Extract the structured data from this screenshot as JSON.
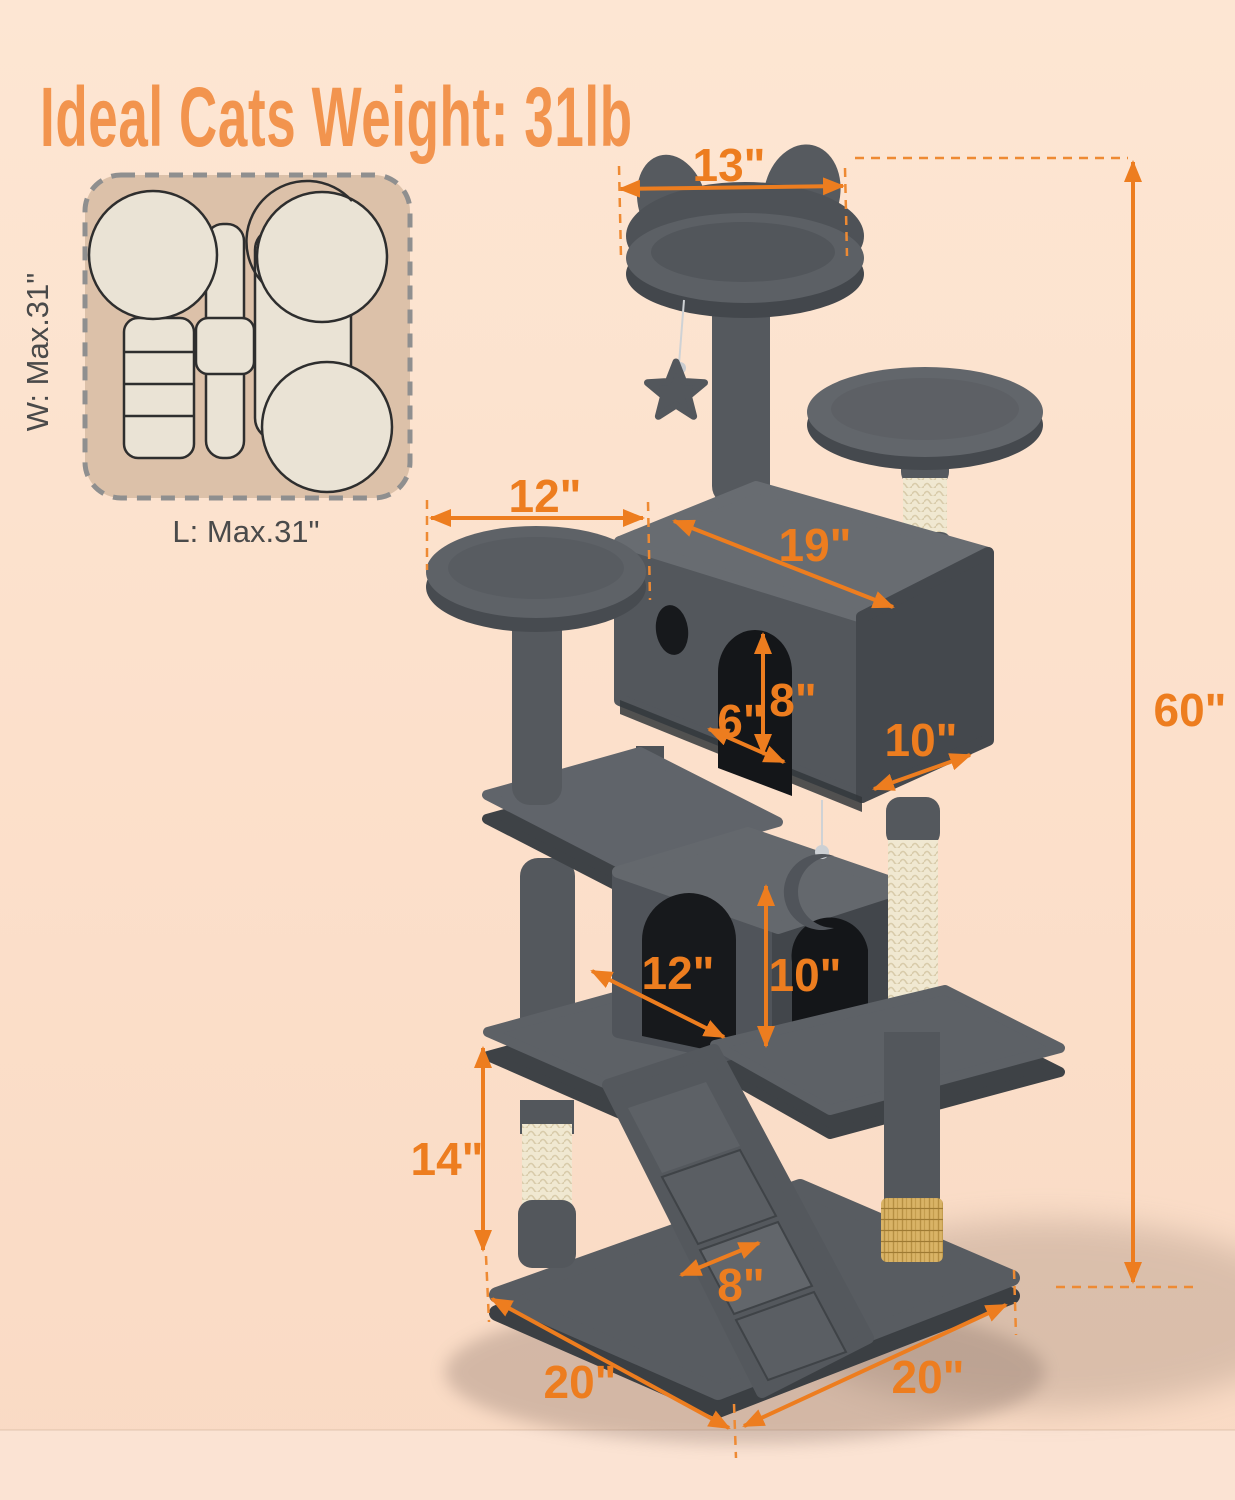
{
  "title": "Ideal Cats Weight: 31lb",
  "footprint_diagram": {
    "width_label": "W: Max.31\"",
    "length_label": "L: Max.31\""
  },
  "dimensions": {
    "top_perch_width": "13\"",
    "total_height": "60\"",
    "left_perch_width": "12\"",
    "top_condo_length": "19\"",
    "top_condo_door_height": "8\"",
    "top_condo_clearance": "6\"",
    "top_condo_depth": "10\"",
    "lower_condo_width": "12\"",
    "lower_condo_door_height": "10\"",
    "lower_post_height": "14\"",
    "ramp_width": "8\"",
    "base_front_left_edge": "20\"",
    "base_front_right_edge": "20\""
  },
  "colors": {
    "background": "#FCE0CB",
    "accent_orange": "#ED7D1F",
    "title_orange": "#F2944E",
    "tree_gray": "#54585D",
    "sisal_cream": "#F0E8D1",
    "brush_gold": "#D9B366",
    "footprint_fill": "#DCC1A9"
  }
}
